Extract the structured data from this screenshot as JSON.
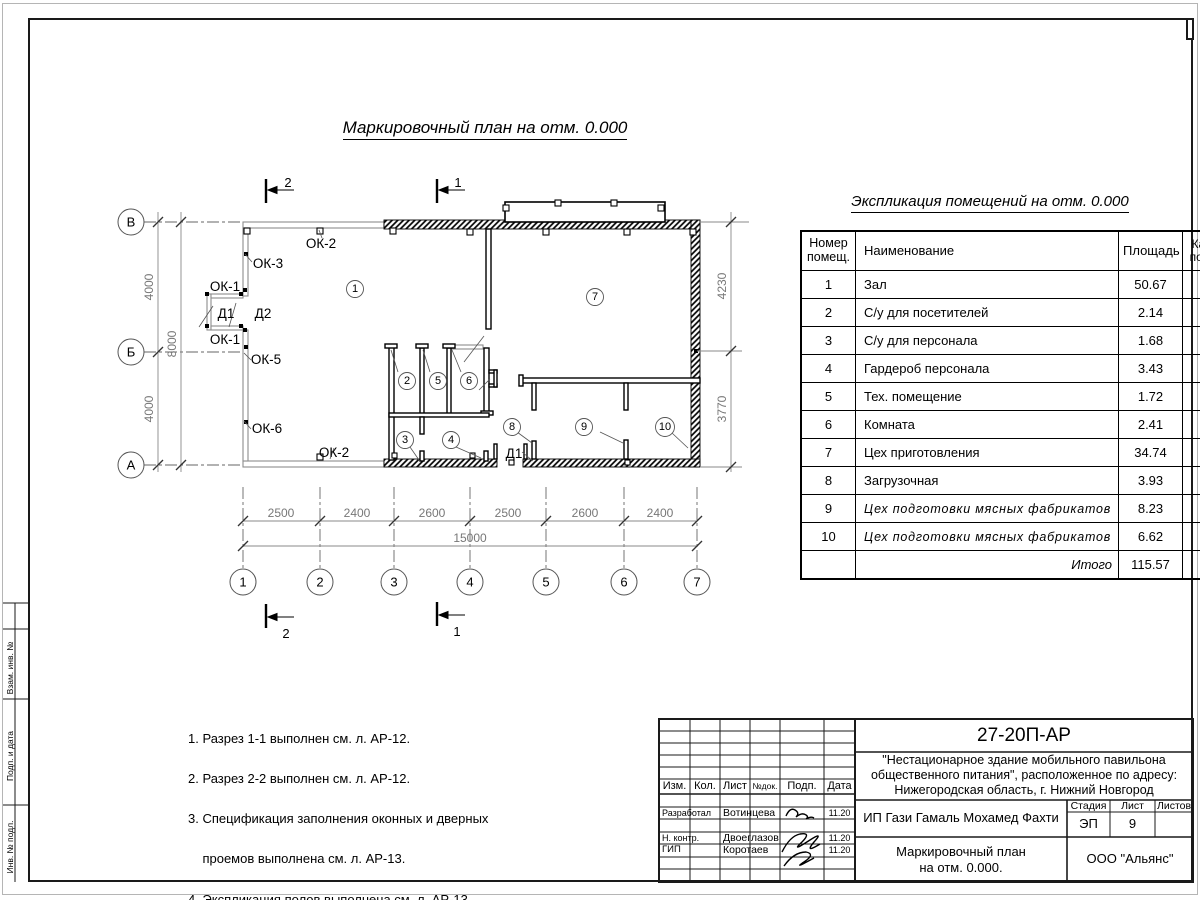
{
  "titles": {
    "plan_title": "Маркировочный план на отм. 0.000",
    "table_title": "Экспликация помещений на отм. 0.000"
  },
  "plan": {
    "axis_letters": [
      "В",
      "Б",
      "А"
    ],
    "axis_numbers": [
      "1",
      "2",
      "3",
      "4",
      "5",
      "6",
      "7"
    ],
    "dims_bottom": [
      "2500",
      "2400",
      "2600",
      "2500",
      "2600",
      "2400"
    ],
    "dim_total": "15000",
    "dims_left": [
      "4000",
      "4000"
    ],
    "dim_left_total": "8000",
    "dims_right": [
      "4230",
      "3770"
    ],
    "sections": {
      "s1": "1",
      "s2": "2"
    },
    "labels": {
      "ok1a": "ОК-1",
      "ok1b": "ОК-1",
      "ok2a": "ОК-2",
      "ok2b": "ОК-2",
      "ok3": "ОК-3",
      "ok5": "ОК-5",
      "ok6": "ОК-6",
      "d1": "Д1",
      "d2": "Д2",
      "d1b": "Д1"
    },
    "rooms": [
      "1",
      "2",
      "3",
      "4",
      "5",
      "6",
      "7",
      "8",
      "9",
      "10"
    ]
  },
  "exp_table": {
    "headers": {
      "num": "Номер помещ.",
      "name": "Наименование",
      "area": "Площадь",
      "cat": "Кат. пом."
    },
    "rows": [
      {
        "num": "1",
        "name": "Зал",
        "area": "50.67"
      },
      {
        "num": "2",
        "name": "С/у для посетителей",
        "area": "2.14"
      },
      {
        "num": "3",
        "name": "С/у для персонала",
        "area": "1.68"
      },
      {
        "num": "4",
        "name": "Гардероб персонала",
        "area": "3.43"
      },
      {
        "num": "5",
        "name": "Тех. помещение",
        "area": "1.72"
      },
      {
        "num": "6",
        "name": "Комната",
        "area": "2.41"
      },
      {
        "num": "7",
        "name": "Цех приготовления",
        "area": "34.74"
      },
      {
        "num": "8",
        "name": "Загрузочная",
        "area": "3.93"
      },
      {
        "num": "9",
        "name": "Цех подготовки мясных фабрикатов",
        "area": "8.23"
      },
      {
        "num": "10",
        "name": "Цех подготовки мясных фабрикатов",
        "area": "6.62"
      }
    ],
    "total_label": "Итого",
    "total_area": "115.57"
  },
  "notes": {
    "lines": [
      "1. Разрез 1-1 выполнен см. л. АР-12.",
      "2. Разрез 2-2 выполнен см. л. АР-12.",
      "3. Спецификация заполнения оконных и дверных",
      "    проемов выполнена см. л. АР-13.",
      "4. Экспликация полов выполнена см. л. АР-13."
    ]
  },
  "stamp": {
    "doc_number": "27-20П-АР",
    "project_line1": "\"Нестационарное здание мобильного павильона",
    "project_line2": "общественного питания\", расположенное по адресу:",
    "project_line3": "Нижегородская область, г. Нижний Новгород",
    "client": "ИП Гази Гамаль Мохамед Фахти",
    "sheet_title_line1": "Маркировочный план",
    "sheet_title_line2": "на отм. 0.000.",
    "company": "ООО \"Альянс\"",
    "cols": {
      "izm": "Изм.",
      "kol": "Кол.",
      "list": "Лист",
      "ndok": "№док.",
      "podp": "Подп.",
      "data": "Дата"
    },
    "stadia_label": "Стадия",
    "list_label": "Лист",
    "listov_label": "Листов",
    "stadia": "ЭП",
    "list_num": "9",
    "roles": [
      {
        "role": "Разработал",
        "name": "Вотинцева",
        "date": "11.20"
      },
      {
        "role": "Н. контр.",
        "name": "Двоеглазов",
        "date": "11.20"
      },
      {
        "role": "ГИП",
        "name": "Коротаев",
        "date": "11.20"
      }
    ]
  },
  "margin_labels": [
    "Взам. инв. №",
    "Подп. и дата",
    "Инв. № подл."
  ]
}
